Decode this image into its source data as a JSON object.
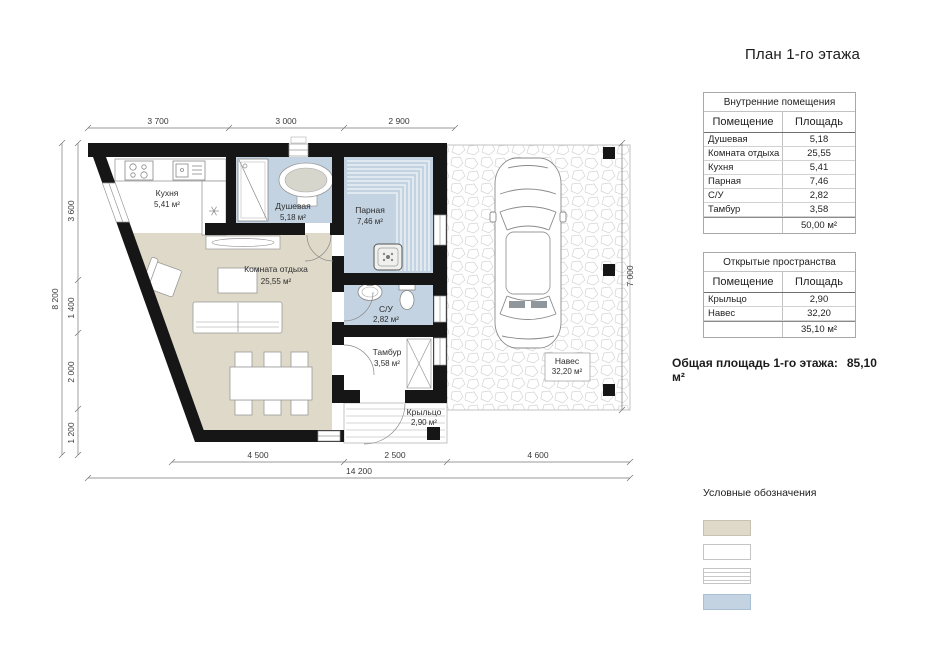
{
  "title": "План 1-го этажа",
  "tables": [
    {
      "header": "Внутренние помещения",
      "columns": [
        "Помещение",
        "Площадь"
      ],
      "rows": [
        [
          "Душевая",
          "5,18"
        ],
        [
          "Комната отдыха",
          "25,55"
        ],
        [
          "Кухня",
          "5,41"
        ],
        [
          "Парная",
          "7,46"
        ],
        [
          "С/У",
          "2,82"
        ],
        [
          "Тамбур",
          "3,58"
        ]
      ],
      "total": "50,00 м²"
    },
    {
      "header": "Открытые пространства",
      "columns": [
        "Помещение",
        "Площадь"
      ],
      "rows": [
        [
          "Крыльцо",
          "2,90"
        ],
        [
          "Навес",
          "32,20"
        ]
      ],
      "total": "35,10 м²"
    }
  ],
  "summary": {
    "label": "Общая площадь 1-го этажа:",
    "value": "85,10 м²"
  },
  "legend": {
    "title": "Условные обозначения",
    "items": [
      {
        "label": "Жилая зона"
      },
      {
        "label": "Общая зона"
      },
      {
        "label": "Открытая зона"
      },
      {
        "label": "Мокрая зона"
      }
    ]
  },
  "plan": {
    "rooms": {
      "kitchen": {
        "name": "Кухня",
        "area": "5,41 м²"
      },
      "shower": {
        "name": "Душевая",
        "area": "5,18 м²"
      },
      "sauna": {
        "name": "Парная",
        "area": "7,46 м²"
      },
      "lounge": {
        "name": "Комната отдыха",
        "area": "25,55 м²"
      },
      "wc": {
        "name": "С/У",
        "area": "2,82 м²"
      },
      "vestibule": {
        "name": "Тамбур",
        "area": "3,58 м²"
      },
      "porch": {
        "name": "Крыльцо",
        "area": "2,90 м²"
      },
      "canopy": {
        "name": "Навес",
        "area": "32,20 м²"
      }
    },
    "dims": {
      "top": [
        "3 700",
        "3 000",
        "2 900"
      ],
      "left": [
        "3 600",
        "1 400",
        "2 000",
        "1 200"
      ],
      "left_total": "8 200",
      "right": "7 000",
      "bottom": [
        "4 500",
        "2 500",
        "4 600"
      ],
      "bottom_total": "14 200"
    }
  },
  "colors": {
    "residential_zone": "#dfd9c9",
    "common_zone": "#ffffff",
    "open_zone_stripe": "#c9c9c9",
    "wet_zone": "#c3d3e2",
    "wall": "#161616"
  }
}
